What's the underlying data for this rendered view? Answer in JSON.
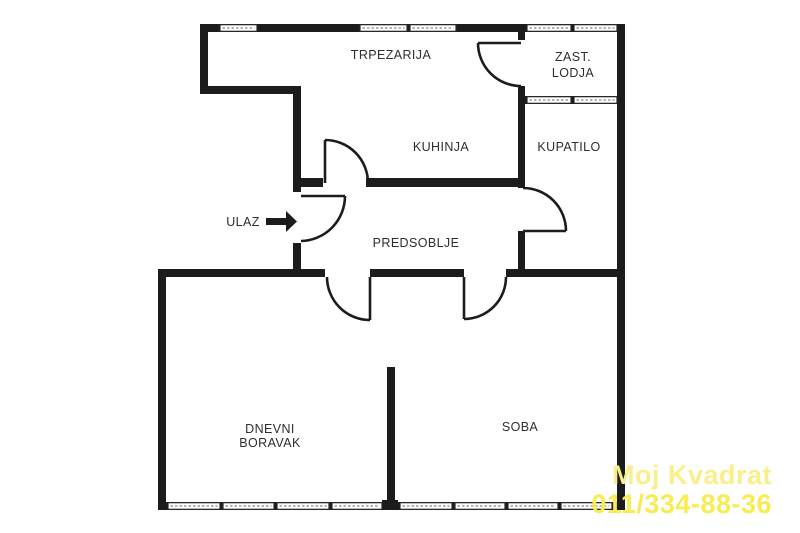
{
  "canvas": {
    "width": 800,
    "height": 533,
    "background": "#ffffff"
  },
  "style": {
    "wall_color": "#1c1c1c",
    "door_line_color": "#1c1c1c",
    "label_color": "#2e2e2e",
    "window_fill": "#ffffff",
    "window_border": "#2a2a2a",
    "window_hatch": "#9a9a9a",
    "watermark_color_line1": "#f9f08d",
    "watermark_color_line2": "#f8ec52"
  },
  "rooms": [
    {
      "id": "trpezarija",
      "text": "TRPEZARIJA",
      "x": 391,
      "y": 59
    },
    {
      "id": "zast-lodja-line1",
      "text": "ZAST.",
      "x": 573,
      "y": 61
    },
    {
      "id": "zast-lodja-line2",
      "text": "LODJA",
      "x": 573,
      "y": 77
    },
    {
      "id": "kuhinja",
      "text": "KUHINJA",
      "x": 441,
      "y": 151
    },
    {
      "id": "kupatilo",
      "text": "KUPATILO",
      "x": 569,
      "y": 151
    },
    {
      "id": "predsoblje",
      "text": "PREDSOBLJE",
      "x": 416,
      "y": 247
    },
    {
      "id": "dnevni-boravak-line1",
      "text": "DNEVNI",
      "x": 270,
      "y": 433
    },
    {
      "id": "dnevni-boravak-line2",
      "text": "BORAVAK",
      "x": 270,
      "y": 447
    },
    {
      "id": "soba",
      "text": "SOBA",
      "x": 520,
      "y": 431
    }
  ],
  "entrance": {
    "label": "ULAZ",
    "label_x": 243,
    "label_y": 226,
    "arrow_points": "266,218 286,218 286,211 297,221.5 286,232 286,225 266,225"
  },
  "walls": [
    [
      200,
      24,
      425,
      8
    ],
    [
      200,
      24,
      8,
      70
    ],
    [
      200,
      86,
      101,
      8
    ],
    [
      293,
      86,
      8,
      106
    ],
    [
      293,
      243,
      8,
      34
    ],
    [
      301,
      178,
      22,
      9
    ],
    [
      366,
      178,
      155,
      9
    ],
    [
      518,
      24,
      7,
      16
    ],
    [
      518,
      86,
      7,
      102
    ],
    [
      518,
      231,
      7,
      46
    ],
    [
      518,
      96,
      107,
      8
    ],
    [
      617,
      24,
      8,
      486
    ],
    [
      158,
      269,
      167,
      8
    ],
    [
      370,
      269,
      94,
      8
    ],
    [
      506,
      269,
      119,
      8
    ],
    [
      158,
      269,
      8,
      241
    ],
    [
      158,
      502,
      467,
      8
    ],
    [
      387,
      367,
      8,
      143
    ],
    [
      382,
      500,
      16,
      10
    ]
  ],
  "windows": [
    [
      220,
      24,
      37,
      8
    ],
    [
      360,
      24,
      47,
      8
    ],
    [
      410,
      24,
      46,
      8
    ],
    [
      527,
      24,
      44,
      8
    ],
    [
      574,
      24,
      43,
      8
    ],
    [
      527,
      96,
      44,
      8
    ],
    [
      574,
      96,
      43,
      8
    ],
    [
      168,
      502,
      52,
      8
    ],
    [
      223,
      502,
      51,
      8
    ],
    [
      277,
      502,
      52,
      8
    ],
    [
      332,
      502,
      50,
      8
    ],
    [
      400,
      502,
      52,
      8
    ],
    [
      455,
      502,
      50,
      8
    ],
    [
      508,
      502,
      50,
      8
    ],
    [
      561,
      502,
      51,
      8
    ]
  ],
  "doors": [
    {
      "id": "door-lodja",
      "leaf": [
        521,
        43,
        478,
        43
      ],
      "arc": "M478,43 A43,43 0 0 0 521,86"
    },
    {
      "id": "door-kuhinja",
      "leaf": [
        325,
        183,
        325,
        140
      ],
      "arc": "M325,140 A43,43 0 0 1 368,183"
    },
    {
      "id": "door-ulaz",
      "leaf": [
        301,
        196,
        345,
        196
      ],
      "arc": "M345,196 A45,45 0 0 1 301,241"
    },
    {
      "id": "door-kupatilo",
      "leaf": [
        523,
        231,
        566,
        231
      ],
      "arc": "M566,231 A43,43 0 0 0 523,188"
    },
    {
      "id": "door-dnevni-boravak",
      "leaf": [
        370,
        277,
        370,
        320
      ],
      "arc": "M327,277 A43,43 0 0 0 370,320"
    },
    {
      "id": "door-soba",
      "leaf": [
        464,
        277,
        464,
        319
      ],
      "arc": "M506,277 A42,42 0 0 1 464,319"
    }
  ],
  "watermark": {
    "line1": "Moj Kvadrat",
    "line2": "011/334-88-36"
  }
}
